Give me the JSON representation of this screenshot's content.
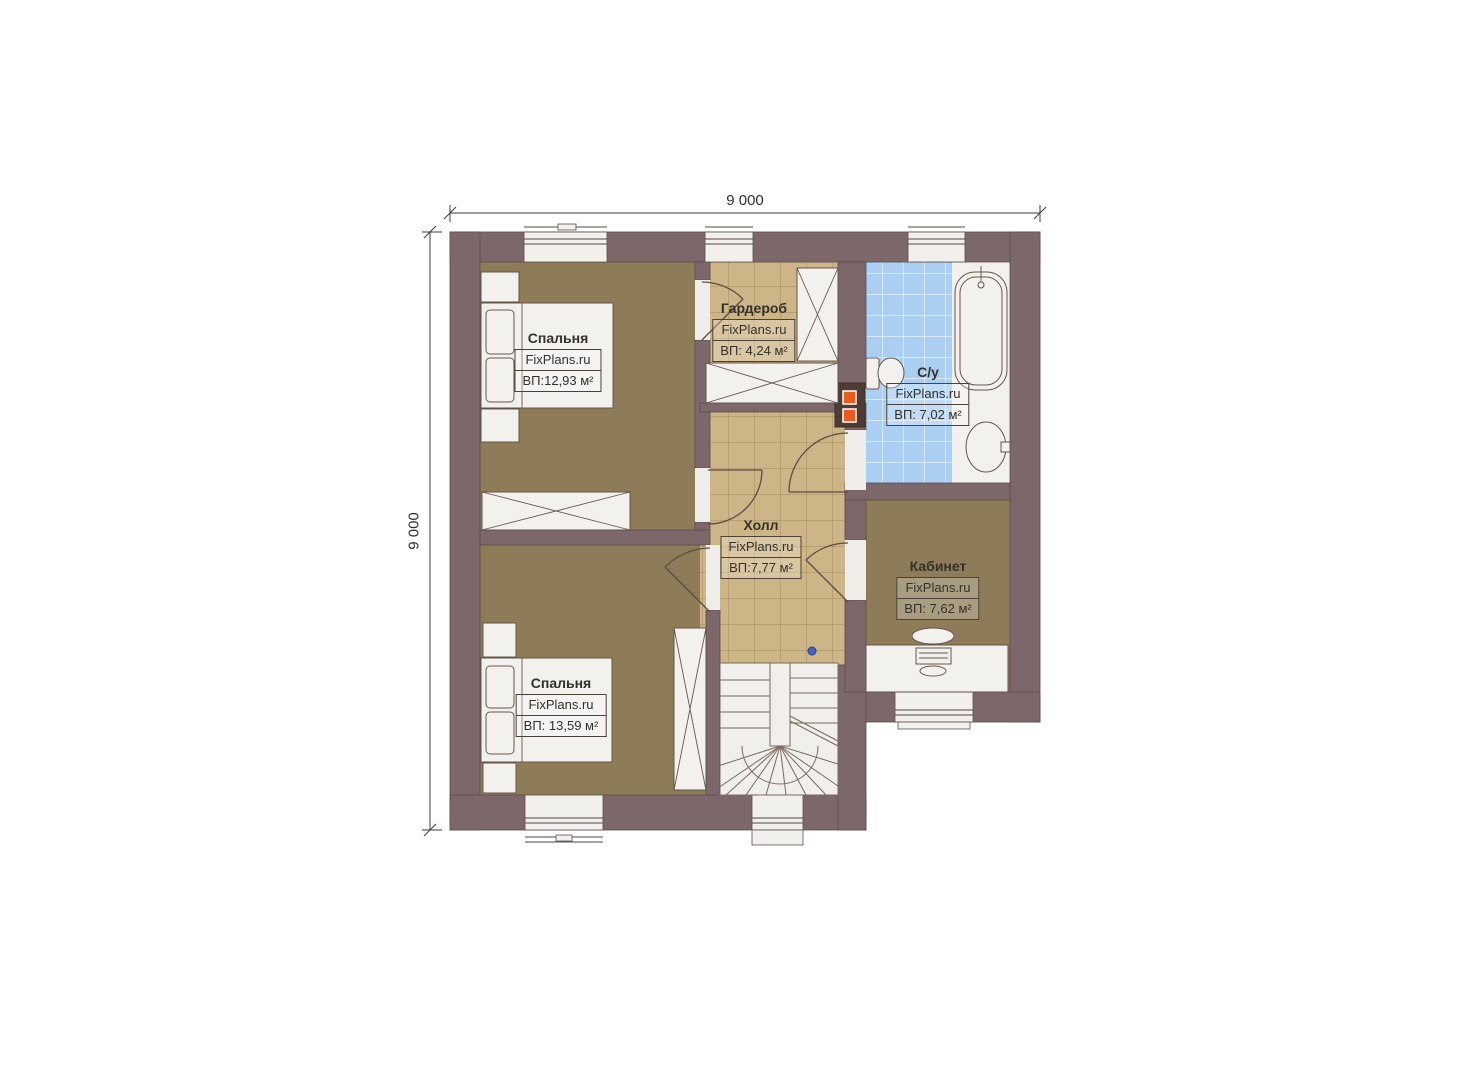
{
  "dimensions": {
    "top": "9 000",
    "left": "9 000"
  },
  "rooms": [
    {
      "id": "bedroom-1",
      "name": "Спальня",
      "brand": "FixPlans.ru",
      "area": "ВП:12,93 м²"
    },
    {
      "id": "wardrobe",
      "name": "Гардероб",
      "brand": "FixPlans.ru",
      "area": "ВП: 4,24 м²"
    },
    {
      "id": "bathroom",
      "name": "С/у",
      "brand": "FixPlans.ru",
      "area": "ВП: 7,02 м²"
    },
    {
      "id": "hall",
      "name": "Холл",
      "brand": "FixPlans.ru",
      "area": "ВП:7,77 м²"
    },
    {
      "id": "office",
      "name": "Кабинет",
      "brand": "FixPlans.ru",
      "area": "ВП: 7,62 м²"
    },
    {
      "id": "bedroom-2",
      "name": "Спальня",
      "brand": "FixPlans.ru",
      "area": "ВП: 13,59 м²"
    }
  ],
  "colors": {
    "wall": "#7c686a",
    "floor_wood": "#8d7c57",
    "floor_tile": "#ccb586",
    "floor_bath": "#abcff2",
    "furniture": "#f2f1ee",
    "accent_orange": "#e85a1d",
    "marker_blue": "#4a63c4"
  }
}
